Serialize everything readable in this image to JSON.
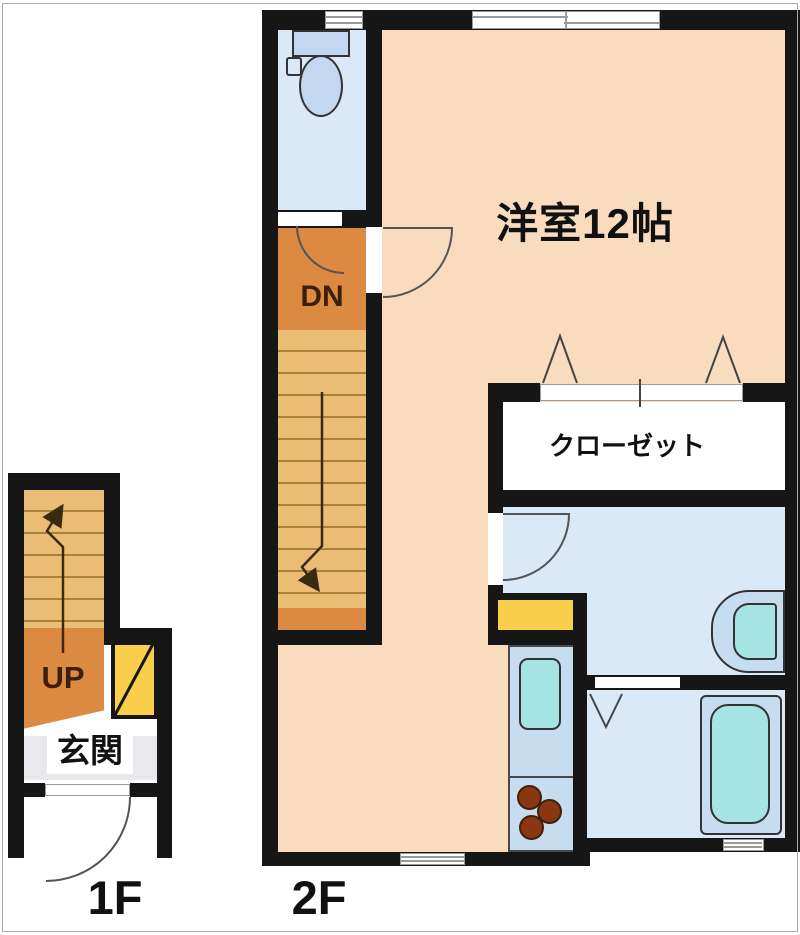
{
  "plan": {
    "floor_1f": {
      "label": "1F",
      "stair_text": "UP",
      "entrance_text": "玄関"
    },
    "floor_2f": {
      "label": "2F",
      "stair_text": "DN",
      "room_text": "洋室12帖",
      "closet_text": "クローゼット"
    },
    "colors": {
      "wall": "#161616",
      "room_floor": "#F8DCBD",
      "wet_room_floor": "#DBE8F5",
      "stair_tread": "#EBBC74",
      "stair_landing": "#DC8A42",
      "fixture_body": "#C6DCEF",
      "fixture_basin": "#A6E3E3",
      "cabinet_yellow": "#F9CE4B",
      "stove_burner": "#8A3711",
      "entrance_floor": "#E9E9ED"
    },
    "fixtures": [
      "toilet",
      "washbasin",
      "bathtub",
      "kitchen-sink",
      "gas-stove",
      "shoe-cabinet"
    ]
  }
}
